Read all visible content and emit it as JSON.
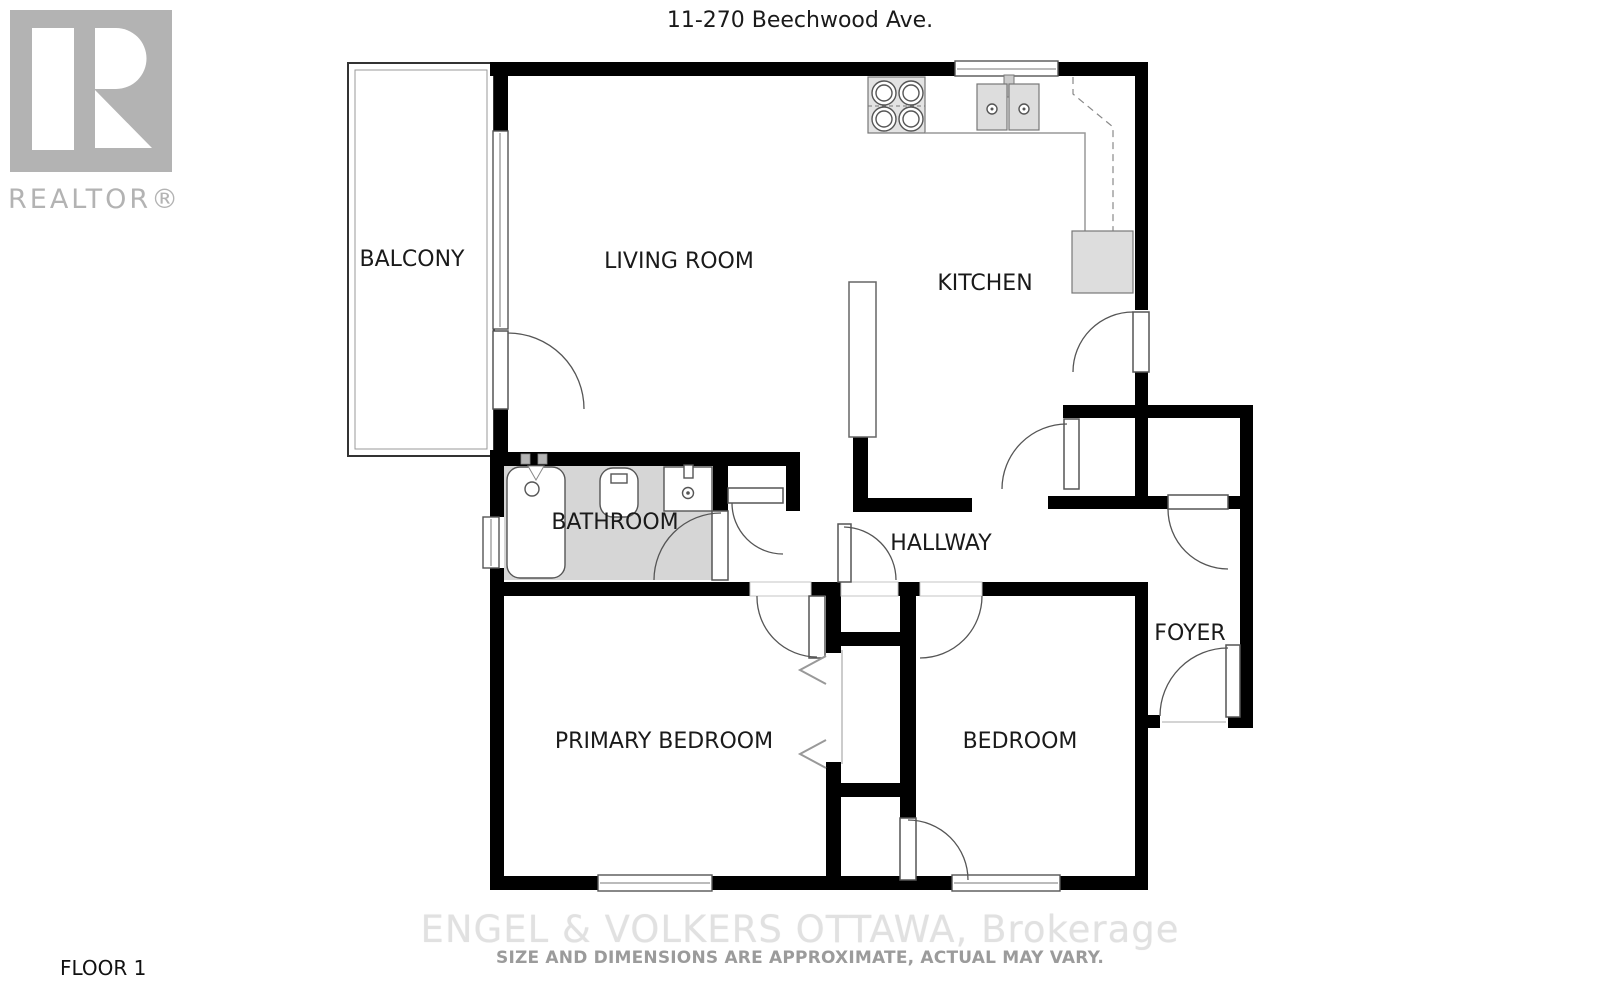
{
  "header": {
    "title": "11-270 Beechwood Ave."
  },
  "branding": {
    "logo_text": "REALTOR®"
  },
  "floor_plan": {
    "rooms": {
      "balcony": "BALCONY",
      "living_room": "LIVING ROOM",
      "kitchen": "KITCHEN",
      "bathroom": "BATHROOM",
      "hallway": "HALLWAY",
      "foyer": "FOYER",
      "primary_bedroom": "PRIMARY BEDROOM",
      "bedroom": "BEDROOM"
    },
    "fixtures": [
      "stove-icon",
      "kitchen-double-sink-icon",
      "refrigerator-icon",
      "bathtub-icon",
      "toilet-icon",
      "bathroom-sink-icon",
      "door-swing-icon",
      "window-icon",
      "bifold-closet-door-icon"
    ]
  },
  "footer": {
    "floor_label": "FLOOR 1",
    "watermark_line1": "ENGEL & VOLKERS OTTAWA, Brokerage",
    "watermark_line2": "SIZE AND DIMENSIONS ARE APPROXIMATE, ACTUAL MAY VARY."
  },
  "colors": {
    "wall": "#000000",
    "bathroom_floor": "#d6d6d6",
    "fixture_gray": "#e3e3e3",
    "appliance_gray": "#dddddd",
    "door_stroke": "#555555",
    "logo_gray": "#b3b3b3",
    "watermark_light": "#e1e1e1",
    "watermark_gray": "#9b9b9b",
    "label_text": "#1a1a1a"
  }
}
